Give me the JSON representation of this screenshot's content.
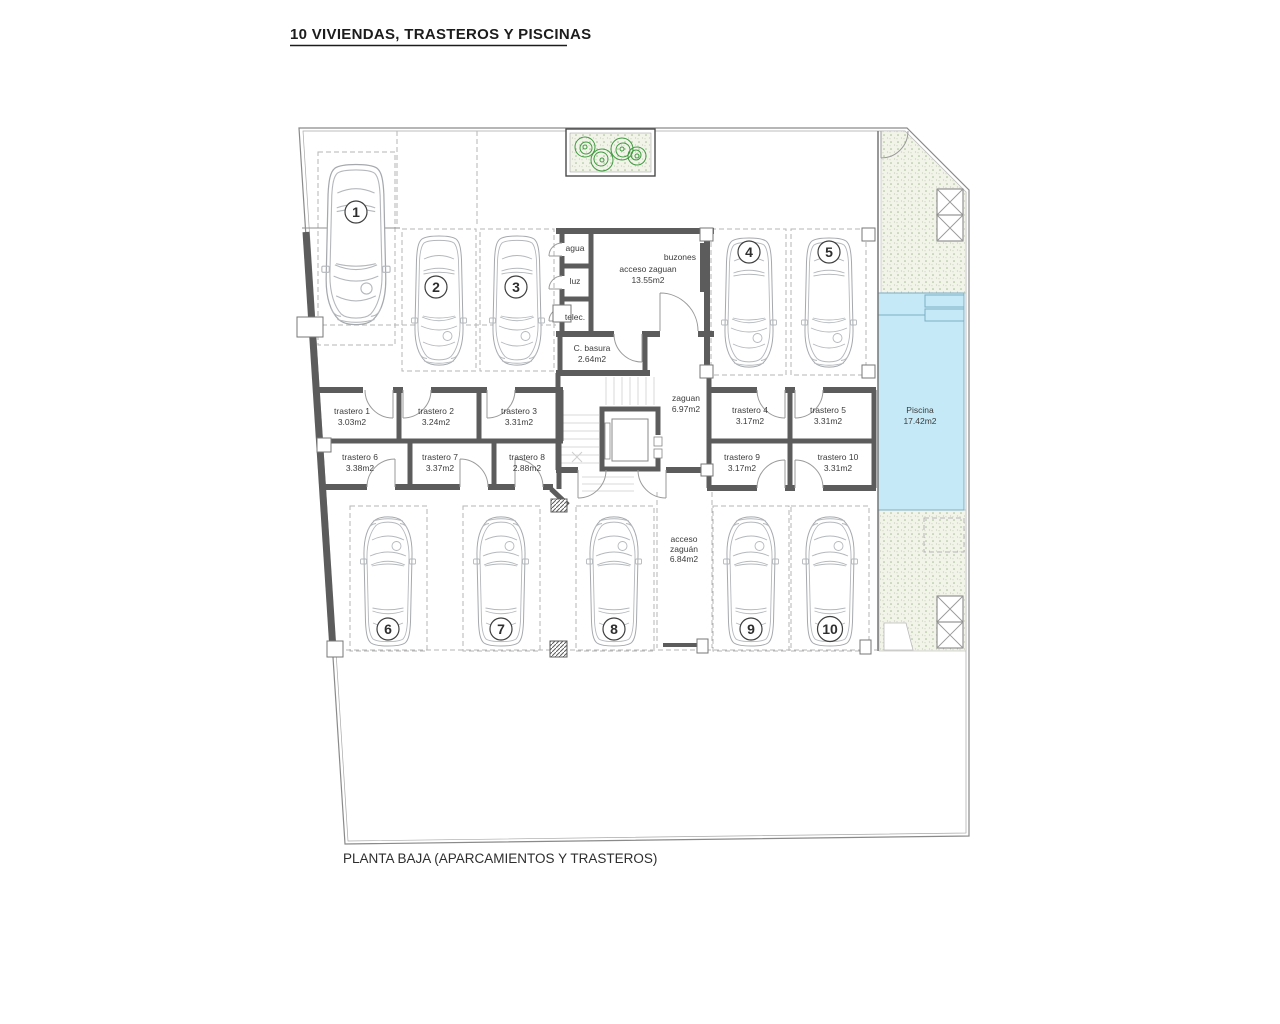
{
  "title": "10 VIVIENDAS, TRASTEROS Y PISCINAS",
  "caption": "PLANTA BAJA (APARCAMIENTOS Y TRASTEROS)",
  "colors": {
    "pool_fill": "#c5e9f6",
    "pool_edge": "#7aaec6",
    "wall": "#5c5c5c",
    "plant_green": "#3f9b3f",
    "garden_base": "#f2f4ea"
  },
  "plan": {
    "utility": {
      "agua": "agua",
      "luz": "luz",
      "telec": "telec."
    },
    "acceso_zaguan_main": {
      "name": "acceso zaguan",
      "area": "13.55m2"
    },
    "buzones": "buzones",
    "c_basura": {
      "name": "C. basura",
      "area": "2.64m2"
    },
    "zaguan": {
      "name": "zaguan",
      "area": "6.97m2"
    },
    "acceso_zaguan_south": {
      "line1": "acceso",
      "line2": "zaguán",
      "area": "6.84m2"
    },
    "piscina": {
      "name": "Piscina",
      "area": "17.42m2"
    }
  },
  "parking_spaces": [
    {
      "number": "1"
    },
    {
      "number": "2"
    },
    {
      "number": "3"
    },
    {
      "number": "4"
    },
    {
      "number": "5"
    },
    {
      "number": "6"
    },
    {
      "number": "7"
    },
    {
      "number": "8"
    },
    {
      "number": "9"
    },
    {
      "number": "10"
    }
  ],
  "trasteros": [
    {
      "name": "trastero 1",
      "area": "3.03m2"
    },
    {
      "name": "trastero 2",
      "area": "3.24m2"
    },
    {
      "name": "trastero 3",
      "area": "3.31m2"
    },
    {
      "name": "trastero 4",
      "area": "3.17m2"
    },
    {
      "name": "trastero 5",
      "area": "3.31m2"
    },
    {
      "name": "trastero 6",
      "area": "3.38m2"
    },
    {
      "name": "trastero 7",
      "area": "3.37m2"
    },
    {
      "name": "trastero 8",
      "area": "2.88m2"
    },
    {
      "name": "trastero 9",
      "area": "3.17m2"
    },
    {
      "name": "trastero 10",
      "area": "3.31m2"
    }
  ]
}
